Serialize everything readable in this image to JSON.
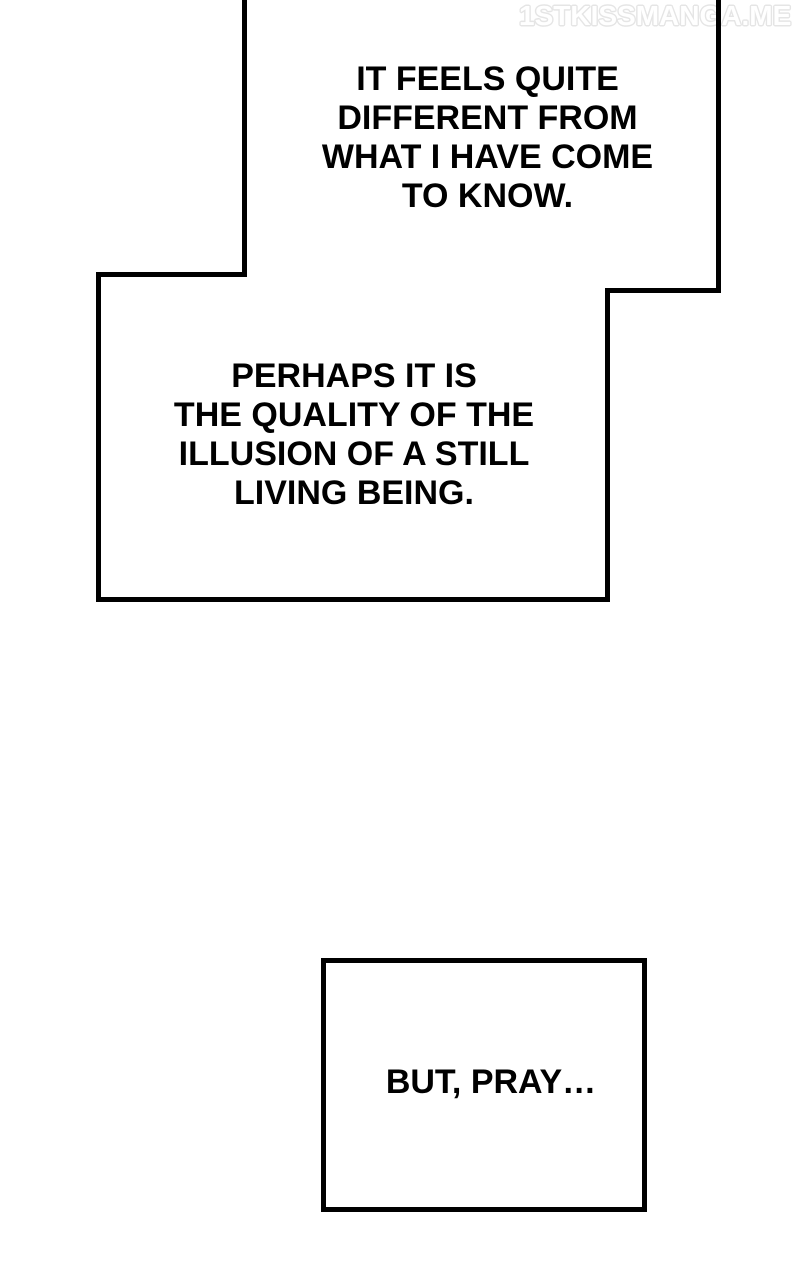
{
  "page": {
    "background": "#ffffff",
    "line_color": "#000000"
  },
  "watermark": {
    "text": "1STKISSMANGA.ME",
    "fill": "#ffffff",
    "outline": "#e5e5e5"
  },
  "bubbles": [
    {
      "name": "speech-bubble-top",
      "lines": [
        "IT FEELS QUITE",
        "DIFFERENT FROM",
        "WHAT I HAVE COME",
        "TO KNOW."
      ]
    },
    {
      "name": "speech-bubble-middle",
      "lines": [
        "PERHAPS IT IS",
        "THE QUALITY OF THE",
        "ILLUSION OF A STILL",
        "LIVING BEING."
      ]
    },
    {
      "name": "speech-bubble-bottom",
      "lines": [
        "BUT, PRAY…"
      ]
    }
  ]
}
